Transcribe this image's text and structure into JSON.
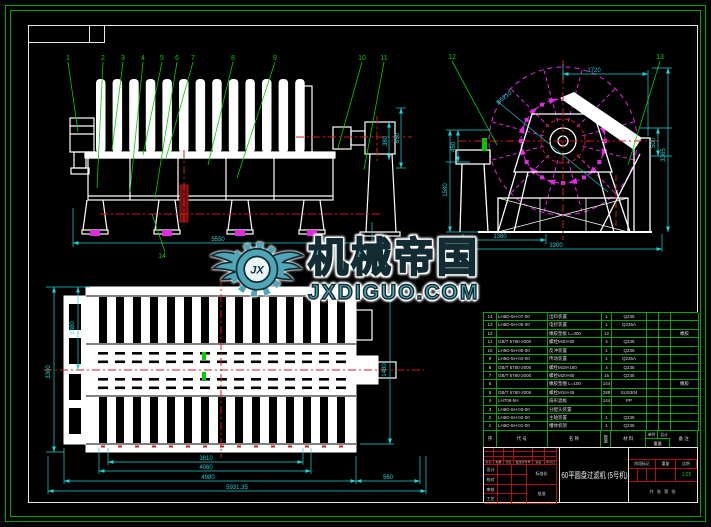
{
  "watermark": {
    "brand": "机械帝国",
    "site": "JXDIGUO.COM",
    "monogram": "JX"
  },
  "front_view": {
    "items": [
      "1",
      "2",
      "3",
      "4",
      "5",
      "6",
      "7",
      "8",
      "9",
      "10",
      "11"
    ],
    "item_bottom": "14",
    "dims": {
      "right_a": "650",
      "right_b": "380",
      "bottom": "5550"
    }
  },
  "side_view": {
    "item_left": "12",
    "item_right": "13",
    "dims": {
      "top": "1720",
      "diameter": "Φ5210",
      "left_a": "450",
      "left_b": "1580",
      "right_a": "500",
      "right_b": "3365",
      "bottom_a": "1380",
      "bottom_b": "3300"
    }
  },
  "plan_view": {
    "dims": {
      "left_a": "1380",
      "left_b": "3300",
      "right_a": "1480",
      "bottom_a": "3810",
      "bottom_b": "4060",
      "bottom_c": "4980",
      "bottom_d": "560",
      "bottom_e": "5931.35"
    }
  },
  "bom": {
    "headers": {
      "seq": "序",
      "code": "代 号",
      "name": "名 称",
      "qty": "数量",
      "material": "材 料",
      "w_each": "单件",
      "w_total": "总计",
      "w_label": "重量",
      "remark": "备 注"
    },
    "rows": [
      {
        "no": "14",
        "code": "LH6D-5H-07-00",
        "name": "出料装置",
        "qty": "1",
        "material": "Q235",
        "w1": "",
        "w2": "",
        "remark": ""
      },
      {
        "no": "13",
        "code": "LH6D-5H-06-00",
        "name": "电控装置",
        "qty": "1",
        "material": "Q235A",
        "w1": "",
        "w2": "",
        "remark": ""
      },
      {
        "no": "12",
        "code": "",
        "name": "橡胶垫板 L=300",
        "qty": "12",
        "material": "",
        "w1": "",
        "w2": "",
        "remark": "橡胶"
      },
      {
        "no": "11",
        "code": "GB/T 5780-2000",
        "name": "螺栓M30×90",
        "qty": "4",
        "material": "Q235",
        "w1": "",
        "w2": "",
        "remark": ""
      },
      {
        "no": "10",
        "code": "LH6D-5H-05-00",
        "name": "反冲装置",
        "qty": "1",
        "material": "Q235",
        "w1": "",
        "w2": "",
        "remark": ""
      },
      {
        "no": "9",
        "code": "LH6D-5H-04-00",
        "name": "传动装置",
        "qty": "1",
        "material": "Q235A",
        "w1": "",
        "w2": "",
        "remark": ""
      },
      {
        "no": "8",
        "code": "GB/T 5780-2000",
        "name": "螺栓M18×180",
        "qty": "4",
        "material": "Q235",
        "w1": "",
        "w2": "",
        "remark": ""
      },
      {
        "no": "7",
        "code": "GB/T 5780-2000",
        "name": "螺栓M20×80",
        "qty": "16",
        "material": "Q235",
        "w1": "",
        "w2": "",
        "remark": ""
      },
      {
        "no": "6",
        "code": "",
        "name": "橡胶垫圈 L=100",
        "qty": "144",
        "material": "",
        "w1": "",
        "w2": "",
        "remark": "橡胶"
      },
      {
        "no": "5",
        "code": "GB/T 5780-2005",
        "name": "螺栓M16×45",
        "qty": "288",
        "material": "SUS304",
        "w1": "",
        "w2": "",
        "remark": ""
      },
      {
        "no": "4",
        "code": "LH708-5H",
        "name": "扇形滤板",
        "qty": "144",
        "material": "PP",
        "w1": "",
        "w2": "",
        "remark": ""
      },
      {
        "no": "3",
        "code": "LH6D-5H-03-00",
        "name": "分配头装置",
        "qty": "",
        "material": "",
        "w1": "",
        "w2": "",
        "remark": ""
      },
      {
        "no": "2",
        "code": "LH6D-5H-02-00",
        "name": "主轴装置",
        "qty": "1",
        "material": "Q235",
        "w1": "",
        "w2": "",
        "remark": ""
      },
      {
        "no": "1",
        "code": "LH6D-5H-01-00",
        "name": "槽体机架",
        "qty": "1",
        "material": "Q235",
        "w1": "",
        "w2": "",
        "remark": ""
      }
    ]
  },
  "title_block": {
    "title": "60平圆盘过滤机 (5号机)",
    "rev_headers": [
      "标记",
      "处数",
      "分区",
      "更改文件号",
      "签名",
      "年月日"
    ],
    "sign_labels": [
      "设计",
      "校对",
      "审核",
      "工艺"
    ],
    "mid_labels": [
      "标准化",
      "批准"
    ],
    "stage_label": "阶段标记",
    "weight_label": "重量",
    "scale_label": "比例",
    "scale_value": "1:25",
    "sheet_info": "共 张 第 张"
  }
}
